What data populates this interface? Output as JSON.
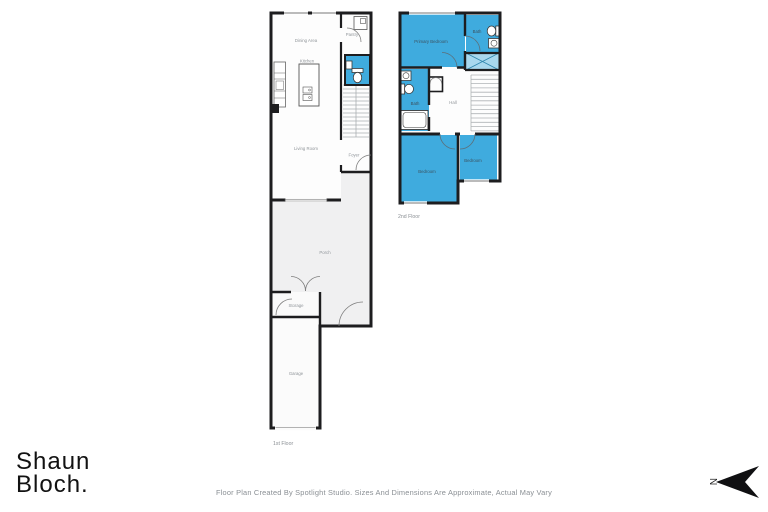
{
  "branding": {
    "logo_line1": "Shaun",
    "logo_line2": "Bloch."
  },
  "footer": {
    "disclaimer": "Floor Plan Created By Spotlight Studio. Sizes And Dimensions Are Approximate, Actual May Vary"
  },
  "compass": {
    "north_label": "N"
  },
  "colors": {
    "highlight_blue": "#3FABDE",
    "closet_blue": "#A9D8EE",
    "porch_gray": "#F0F0F1",
    "wall_dark": "#1D1D1F"
  },
  "floor1": {
    "floor_label": "1st Floor",
    "rooms": {
      "dining_area": "Dining Area",
      "kitchen": "Kitchen",
      "pantry": "Pantry",
      "living_room": "Living Room",
      "foyer": "Foyer",
      "porch": "Porch",
      "storage": "Storage",
      "garage": "Garage"
    }
  },
  "floor2": {
    "floor_label": "2nd Floor",
    "rooms": {
      "primary_bedroom": "Primary Bedroom",
      "bath_upper": "Bath",
      "bath_lower": "Bath",
      "hall": "Hall",
      "bedroom_left": "Bedroom",
      "bedroom_right": "Bedroom"
    }
  }
}
